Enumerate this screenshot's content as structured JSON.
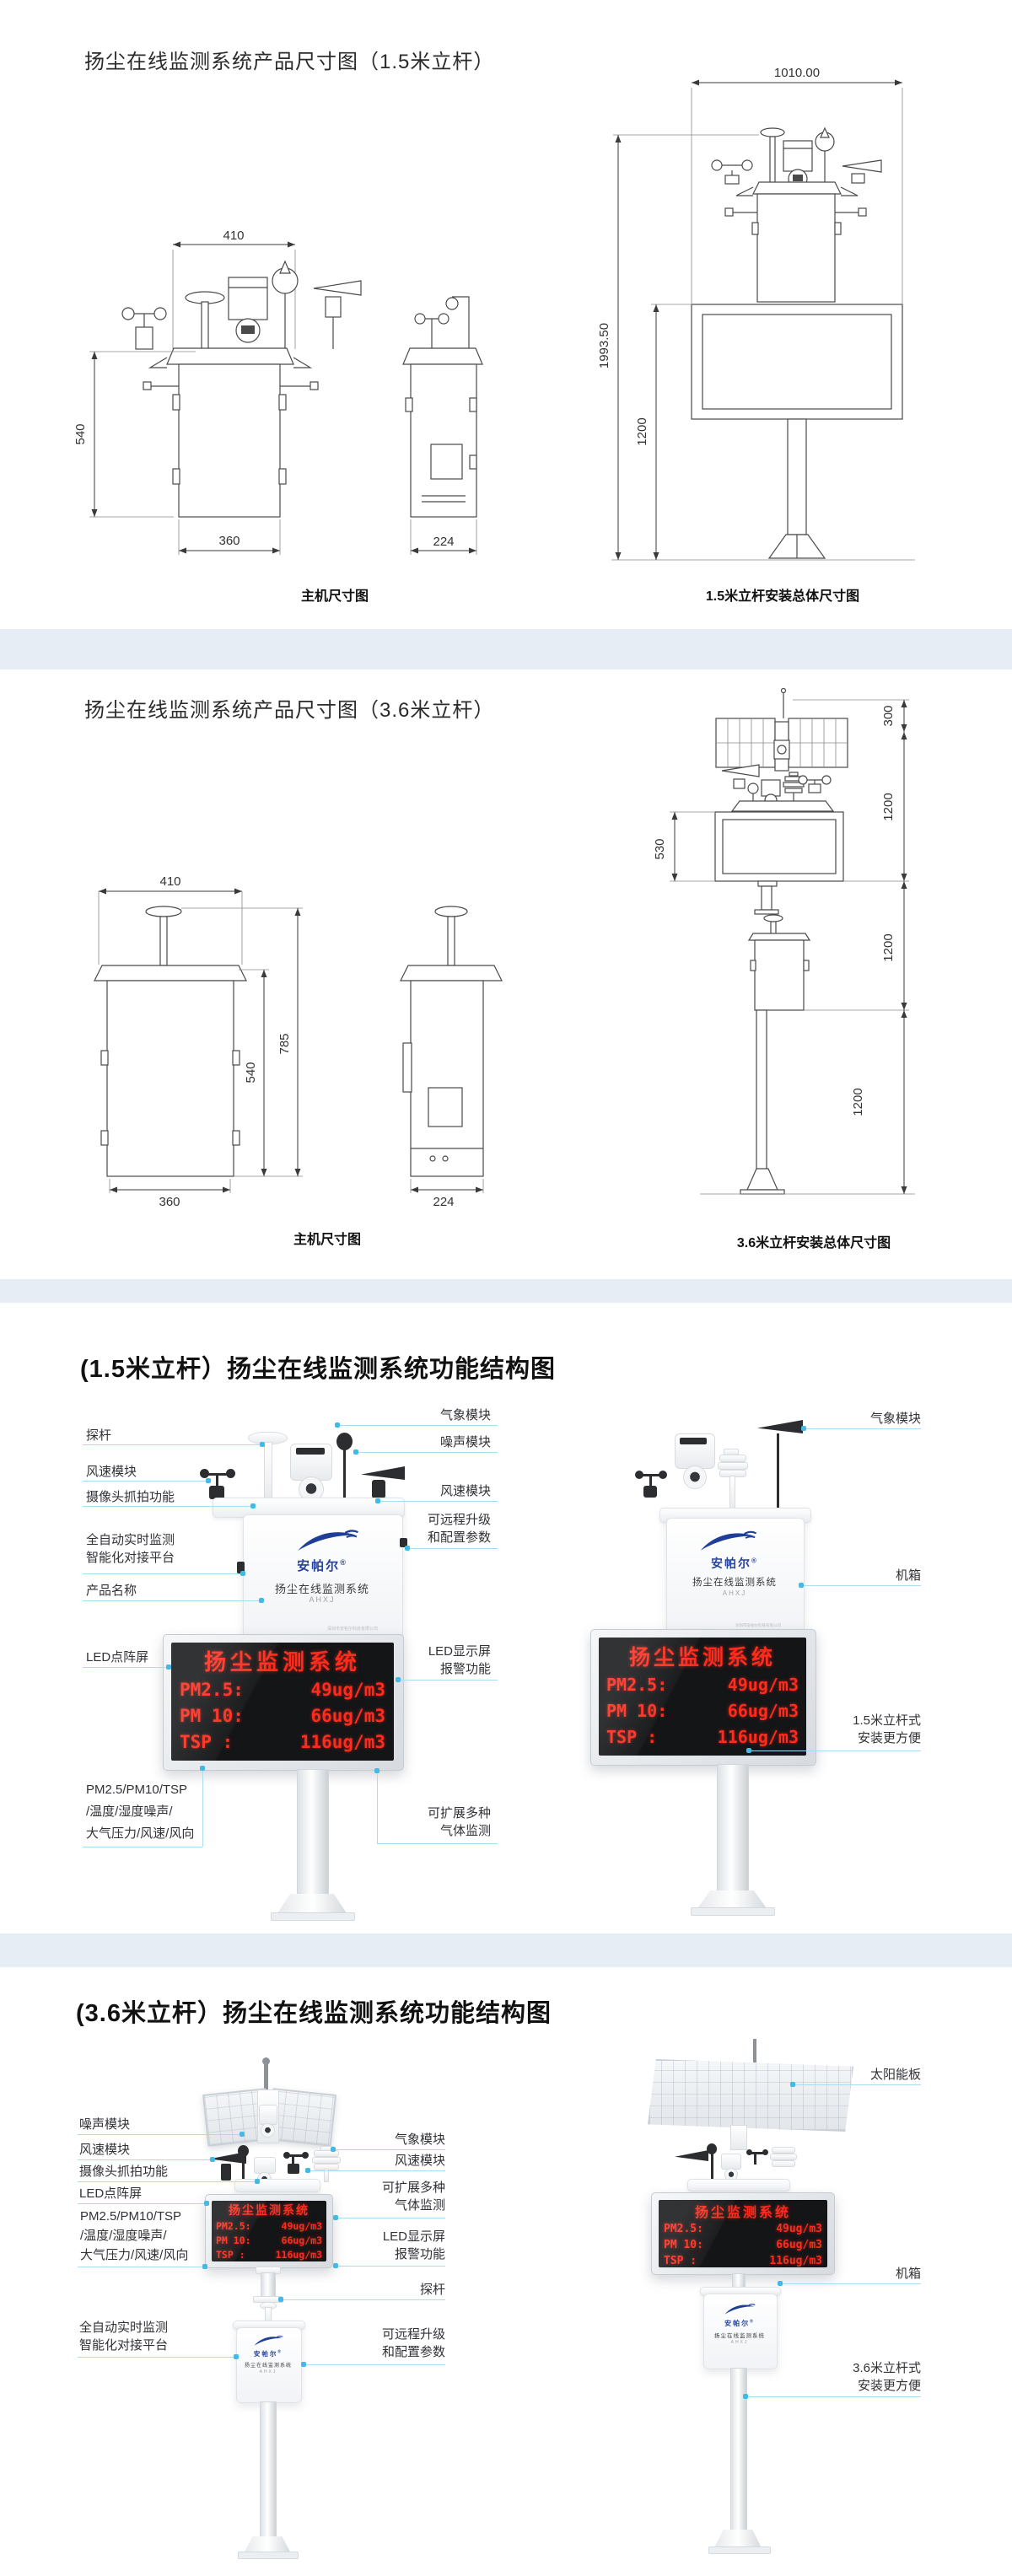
{
  "colors": {
    "led_red": "#ff2b1c",
    "callout_line": "#a9dcf0",
    "brand_blue": "#27439b",
    "separator_band": "#e7edf5"
  },
  "section1": {
    "title": "扬尘在线监测系统产品尺寸图（1.5米立杆）",
    "front": {
      "dim_top": "410",
      "dim_left": "540",
      "dim_bottom": "360"
    },
    "side": {
      "dim_bottom": "224"
    },
    "caption_main": "主机尺寸图",
    "pole": {
      "dim_top": "1010.00",
      "dim_total": "1993.50",
      "dim_lower": "1200"
    },
    "caption_pole": "1.5米立杆安装总体尺寸图"
  },
  "section2": {
    "title": "扬尘在线监测系统产品尺寸图（3.6米立杆）",
    "front": {
      "dim_top": "410",
      "dim_mid": "540",
      "dim_right": "785",
      "dim_bottom": "360"
    },
    "side": {
      "dim_bottom": "224"
    },
    "caption_main": "主机尺寸图",
    "pole": {
      "dim_300": "300",
      "dim_1200_a": "1200",
      "dim_530": "530",
      "dim_1200_b": "1200",
      "dim_1200_c": "1200"
    },
    "caption_pole": "3.6米立杆安装总体尺寸图"
  },
  "section3": {
    "title": "(1.5米立杆）扬尘在线监测系统功能结构图",
    "left": {
      "probe": "探杆",
      "wind": "风速模块",
      "camera": "摄像头抓拍功能",
      "auto1": "全自动实时监测",
      "auto2": "智能化对接平台",
      "product_name": "产品名称",
      "led_dot": "LED点阵屏",
      "pm1": "PM2.5/PM10/TSP",
      "pm2": "/温度/湿度噪声/",
      "pm3": "大气压力/风速/风向"
    },
    "mid": {
      "weather": "气象模块",
      "noise": "噪声模块",
      "wind": "风速模块",
      "remote1": "可远程升级",
      "remote2": "和配置参数",
      "led_alarm1": "LED显示屏",
      "led_alarm2": "报警功能",
      "gas1": "可扩展多种",
      "gas2": "气体监测"
    },
    "right": {
      "weather": "气象模块",
      "cabinet": "机箱",
      "pole1": "1.5米立杆式",
      "pole2": "安装更方便"
    }
  },
  "section4": {
    "title": "(3.6米立杆）扬尘在线监测系统功能结构图",
    "left": {
      "noise": "噪声模块",
      "wind": "风速模块",
      "camera": "摄像头抓拍功能",
      "led_dot": "LED点阵屏",
      "pm1": "PM2.5/PM10/TSP",
      "pm2": "/温度/湿度噪声/",
      "pm3": "大气压力/风速/风向",
      "auto1": "全自动实时监测",
      "auto2": "智能化对接平台"
    },
    "mid": {
      "weather": "气象模块",
      "wind": "风速模块",
      "gas1": "可扩展多种",
      "gas2": "气体监测",
      "led_alarm1": "LED显示屏",
      "led_alarm2": "报警功能",
      "probe": "探杆",
      "remote1": "可远程升级",
      "remote2": "和配置参数"
    },
    "right": {
      "solar": "太阳能板",
      "cabinet": "机箱",
      "pole1": "3.6米立杆式",
      "pole2": "安装更方便"
    }
  },
  "device": {
    "brand": "安帕尔",
    "brand_reg": "®",
    "name_line": "扬尘在线监测系统",
    "model_line": "AHXJ",
    "company_line": "深圳市安帕尔科技有限公司",
    "led": {
      "title": "扬尘监测系统",
      "rows": [
        {
          "label": "PM2.5:",
          "value": "49ug/m3"
        },
        {
          "label": "PM 10:",
          "value": "66ug/m3"
        },
        {
          "label": "TSP  :",
          "value": "116ug/m3"
        }
      ]
    }
  }
}
